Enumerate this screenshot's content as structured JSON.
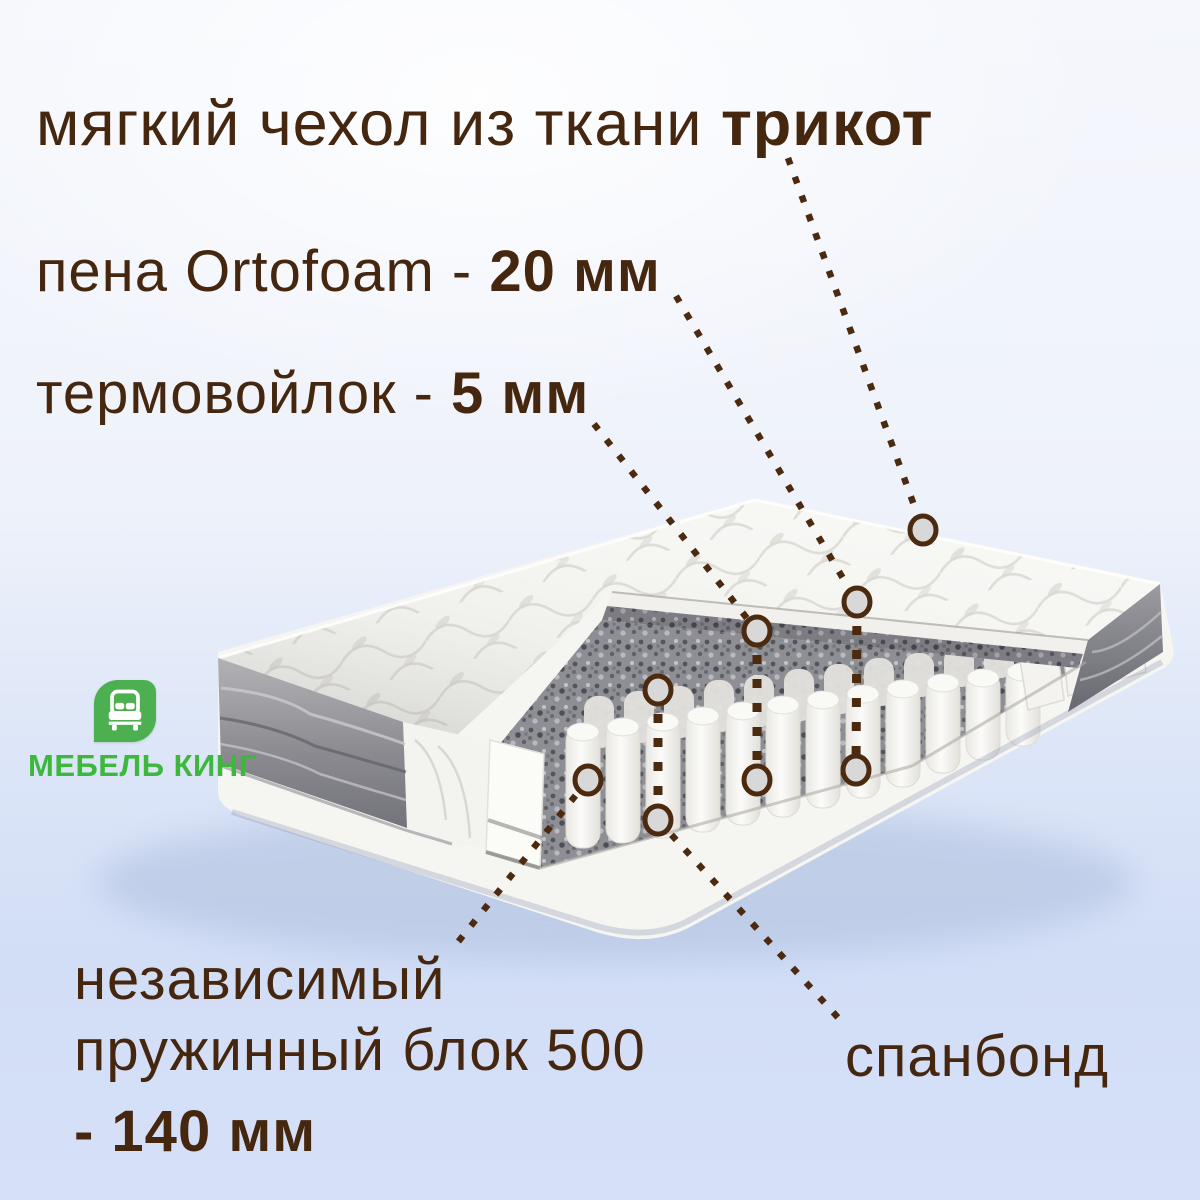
{
  "page": {
    "background_top": "#f5f7fc",
    "background_bottom": "#d2def6"
  },
  "colors": {
    "text_brown": "#45260f",
    "callout_line": "#4b2a10",
    "callout_circle_fill": "#d8d8d8",
    "logo_green": "#4caf50",
    "logo_text_green": "#3db83d"
  },
  "callouts": {
    "cover": {
      "prefix": "мягкий чехол из ткани ",
      "value": "трикот"
    },
    "foam": {
      "prefix": "пена Ortofoam - ",
      "value": "20 мм"
    },
    "felt": {
      "prefix": "термовойлок - ",
      "value": "5 мм"
    },
    "spring_block": {
      "line1": "независимый",
      "line2": "пружинный блок 500",
      "value": "- 140 мм"
    },
    "spunbond": {
      "label": "спанбонд"
    }
  },
  "logo": {
    "caption": "МЕБЕЛЬ КИНГ",
    "icon": "bed-icon"
  }
}
